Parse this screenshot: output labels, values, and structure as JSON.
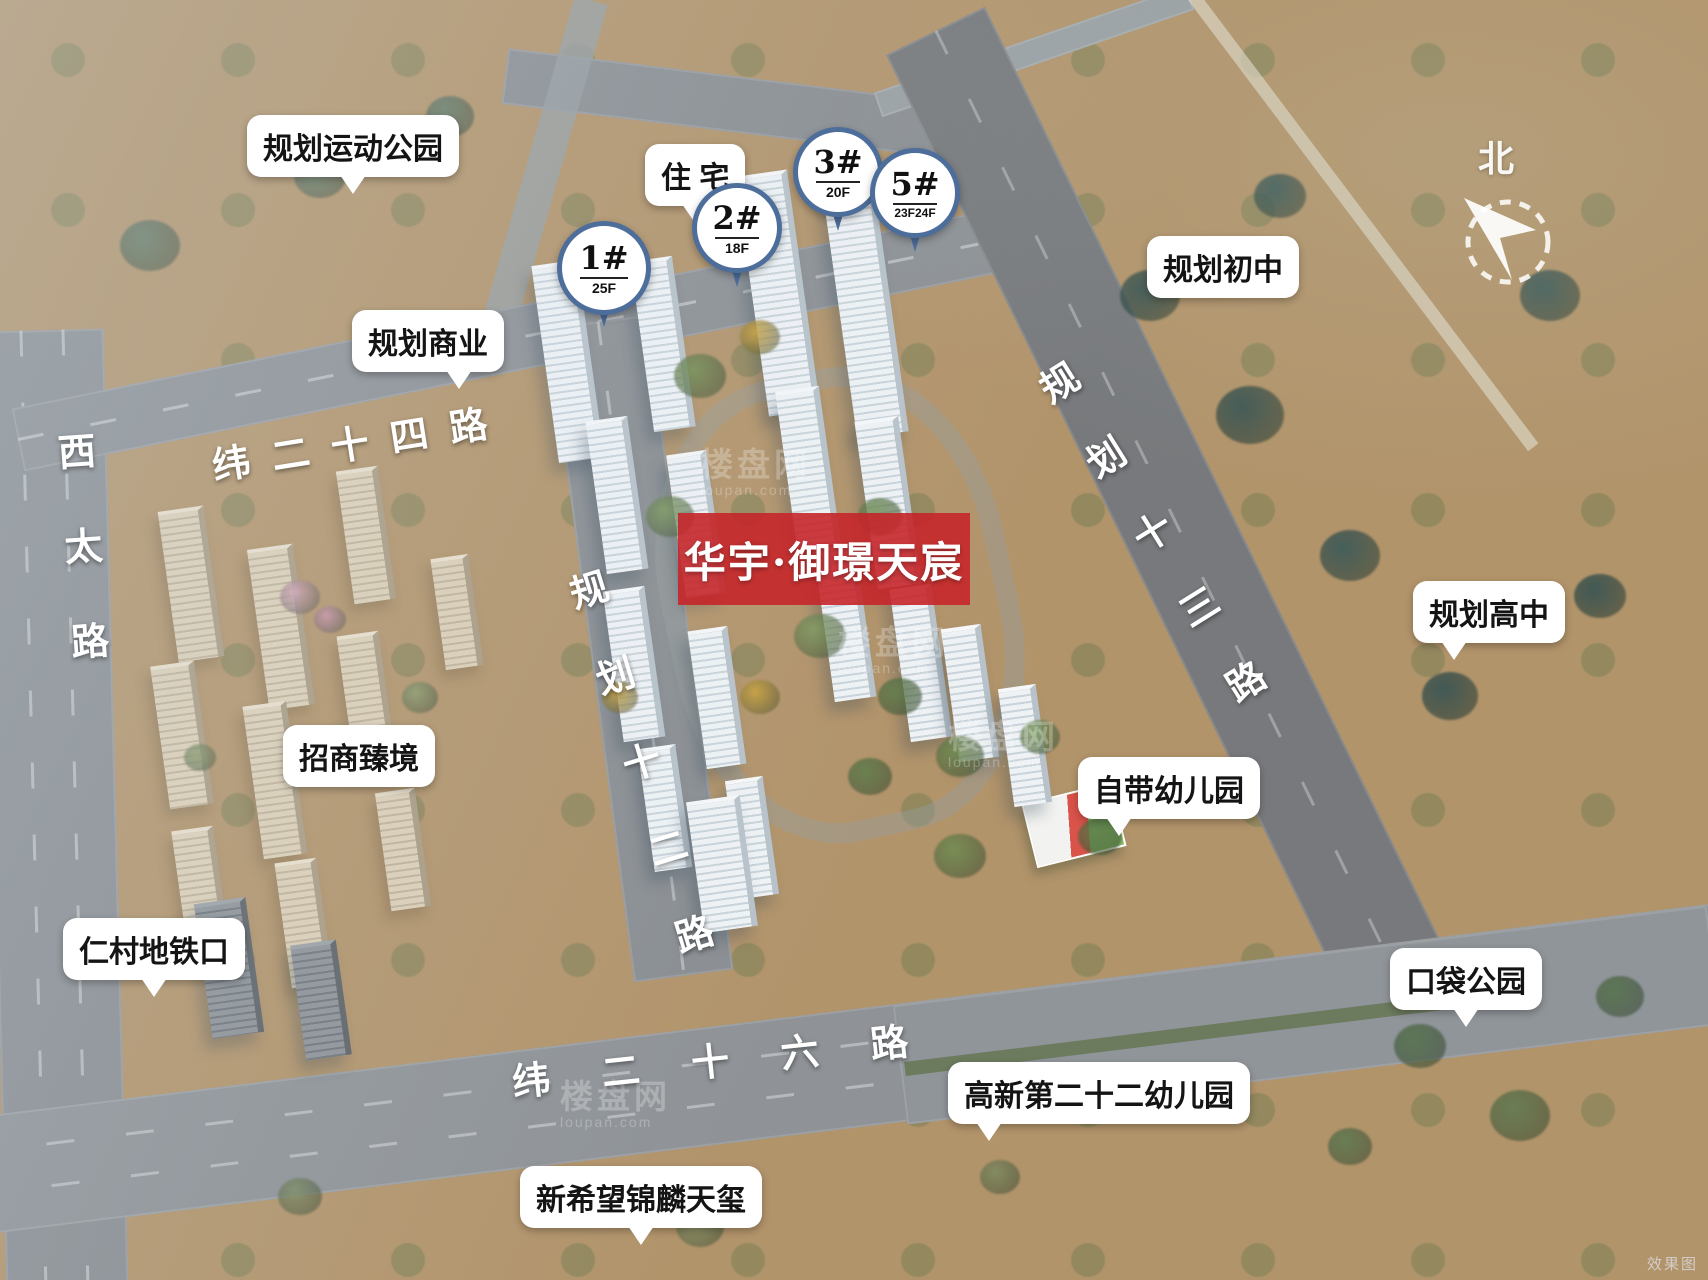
{
  "app": {
    "corner_note": "效果图"
  },
  "banner": {
    "title": "华宇·御璟天宸",
    "bg_color": "#c5262a"
  },
  "compass": {
    "label": "北"
  },
  "watermark": {
    "cn": "楼盘网",
    "en": "loupan.com"
  },
  "watermarks": [
    {
      "x": 700,
      "y": 448
    },
    {
      "x": 838,
      "y": 626
    },
    {
      "x": 948,
      "y": 720
    },
    {
      "x": 560,
      "y": 1080
    }
  ],
  "site_balloons": [
    {
      "id": "tower-1",
      "num": "1#",
      "floors": "25F",
      "x": 557,
      "y": 221,
      "size": 94
    },
    {
      "id": "tower-2",
      "num": "2#",
      "floors": "18F",
      "x": 692,
      "y": 183,
      "size": 90
    },
    {
      "id": "tower-3",
      "num": "3#",
      "floors": "20F",
      "x": 793,
      "y": 127,
      "size": 90
    },
    {
      "id": "tower-5",
      "num": "5#",
      "floors": "23F24F",
      "x": 870,
      "y": 148,
      "size": 90
    }
  ],
  "callouts": [
    {
      "id": "planned-sports-park",
      "label": "规划运动公园",
      "x": 247,
      "y": 115,
      "pointer": "bc"
    },
    {
      "id": "residential",
      "label": "住 宅",
      "x": 645,
      "y": 144,
      "pointer": "bc"
    },
    {
      "id": "planned-junior-high",
      "label": "规划初中",
      "x": 1147,
      "y": 236,
      "pointer": "none"
    },
    {
      "id": "planned-commercial",
      "label": "规划商业",
      "x": 352,
      "y": 310,
      "pointer": "br"
    },
    {
      "id": "planned-senior-high",
      "label": "规划高中",
      "x": 1413,
      "y": 581,
      "pointer": "bl"
    },
    {
      "id": "zhaoshang-zhenjing",
      "label": "招商臻境",
      "x": 283,
      "y": 725,
      "pointer": "none"
    },
    {
      "id": "own-kindergarten",
      "label": "自带幼儿园",
      "x": 1078,
      "y": 757,
      "pointer": "bl"
    },
    {
      "id": "rencun-metro-entrance",
      "label": "仁村地铁口",
      "x": 63,
      "y": 918,
      "pointer": "bc"
    },
    {
      "id": "pocket-park",
      "label": "口袋公园",
      "x": 1390,
      "y": 948,
      "pointer": "bc"
    },
    {
      "id": "gaoxin-22-kindergarten",
      "label": "高新第二十二幼儿园",
      "x": 948,
      "y": 1062,
      "pointer": "bl"
    },
    {
      "id": "xinxiwang-jinlin-tianxi",
      "label": "新希望锦麟天玺",
      "x": 520,
      "y": 1166,
      "pointer": "bc"
    }
  ],
  "roads": [
    {
      "id": "xitai-road",
      "label": "西太路",
      "classes": "rl-vert rl-xitai"
    },
    {
      "id": "wei-24-road",
      "label": "纬二十四路",
      "classes": "rl-w24"
    },
    {
      "id": "guihua-12-road",
      "label": "规划十二路",
      "classes": "rl-vert rl-g12"
    },
    {
      "id": "guihua-13-road",
      "label": "规划十三路",
      "classes": "rl-vert rl-g13"
    },
    {
      "id": "wei-26-road",
      "label": "纬二十六路",
      "classes": "rl-w26"
    }
  ]
}
